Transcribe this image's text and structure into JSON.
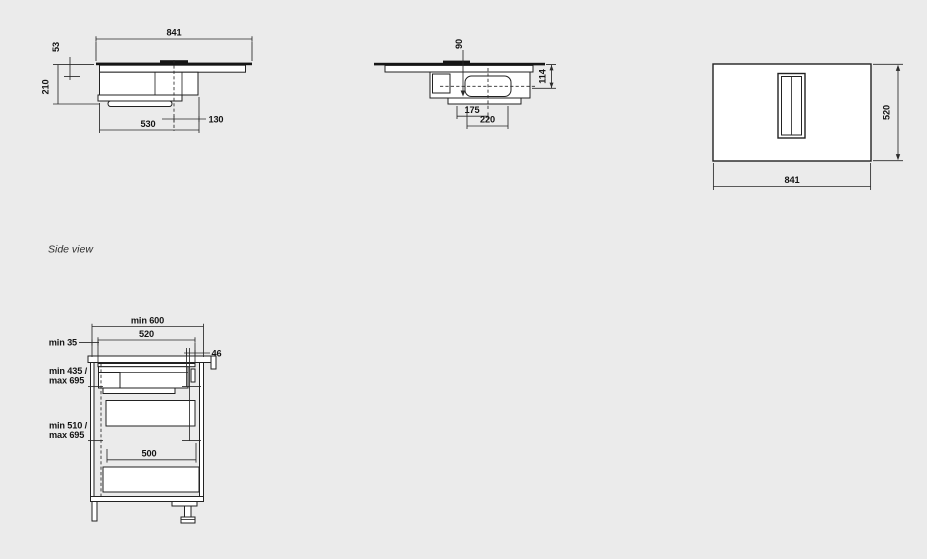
{
  "drawing": {
    "background": "#ebebeb",
    "ink": "#222222",
    "side_view_label": "Side view",
    "front_view": {
      "width": "841",
      "top_height": "53",
      "total_height": "210",
      "body_width": "530",
      "duct_offset": "130"
    },
    "profile_view": {
      "duct_drop": "90",
      "inlet_depth": "114",
      "outlet_setback": "175",
      "outlet_length": "220"
    },
    "plan_view": {
      "depth": "520",
      "width": "841"
    },
    "install_view": {
      "cabinet_width": "min 600",
      "hob_width": "520",
      "left_gap": "min 35",
      "right_gap": "46",
      "upper_clearance_1": "min 435 /",
      "upper_clearance_2": "max 695",
      "lower_clearance_1": "min 510 /",
      "lower_clearance_2": "max 695",
      "drawer_width": "500"
    }
  }
}
